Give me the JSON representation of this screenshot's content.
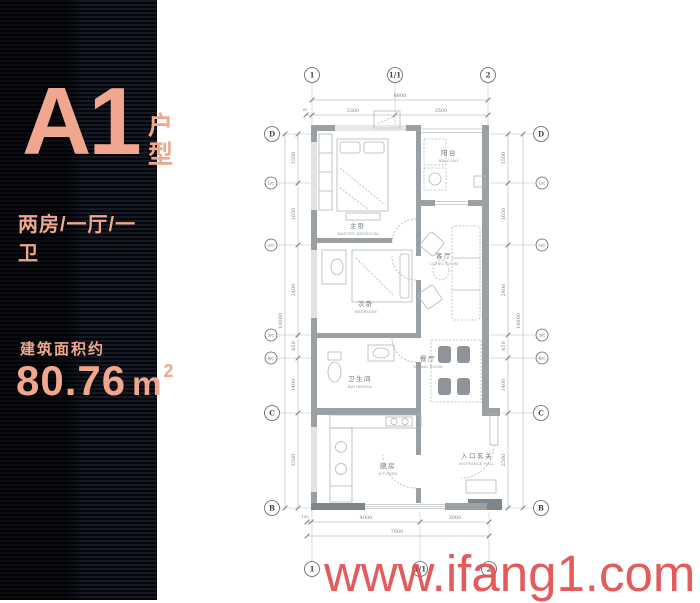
{
  "left_panel": {
    "unit_name": "A1",
    "unit_suffix": "户型",
    "layout_desc": "两房/一厅/一卫",
    "area_label": "建筑面积约",
    "area_value": "80.76",
    "area_unit": "m",
    "area_sup": "2",
    "accent_color": "#f0a78d",
    "bg_color": "#0a0d15"
  },
  "watermark": {
    "text": "www.ifang1.com",
    "color": "#e14d4d"
  },
  "plan": {
    "rooms": [
      {
        "zh": "主卧",
        "en": "MASTER BEDROOM"
      },
      {
        "zh": "次卧",
        "en": "BEDROOM"
      },
      {
        "zh": "卫生间",
        "en": "BATHROOM"
      },
      {
        "zh": "厨房",
        "en": "KITCHEN"
      },
      {
        "zh": "客厅",
        "en": "LIVING ROOM"
      },
      {
        "zh": "餐厅",
        "en": "DINING ROOM"
      },
      {
        "zh": "阳台",
        "en": "BALCONY"
      },
      {
        "zh": "入口玄关",
        "en": "ENTRANCE HALL"
      }
    ],
    "grid": {
      "top": [
        "1",
        "1/1",
        "2"
      ],
      "bottom": [
        "1",
        "1/1",
        "2"
      ],
      "left": [
        "D",
        "1/C",
        "2/C",
        "3/C",
        "4/C",
        "C",
        "B"
      ],
      "right": [
        "D",
        "1/C",
        "2/C",
        "3/C",
        "4/C",
        "C",
        "B"
      ]
    },
    "dims": {
      "top_total": "6800",
      "top_segments": [
        "60",
        "3300",
        "3500"
      ],
      "bottom_total": "7000",
      "bottom_segments": [
        "100",
        "4000",
        "3000"
      ],
      "left_total": "10000",
      "left_segments": [
        "1500",
        "1650",
        "2400",
        "650",
        "1400",
        "2500"
      ],
      "right_total": "10000",
      "right_segments": [
        "1500",
        "1650",
        "2400",
        "650",
        "1400",
        "2500"
      ]
    }
  }
}
